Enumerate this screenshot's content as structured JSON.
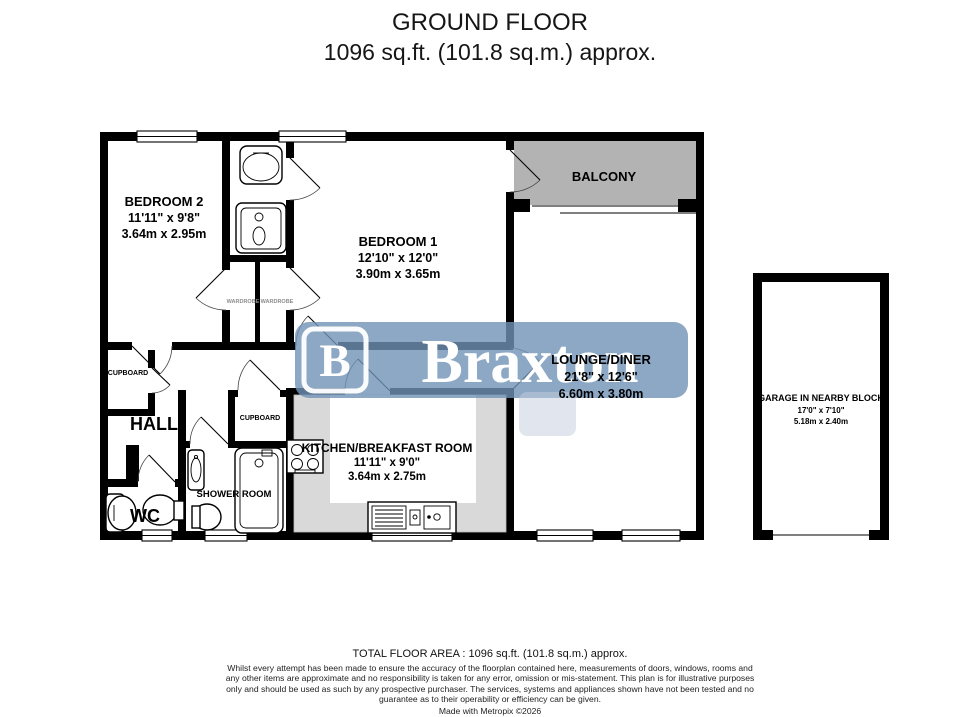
{
  "title": {
    "line1": "GROUND FLOOR",
    "line2": "1096 sq.ft. (101.8 sq.m.) approx."
  },
  "watermark": {
    "brand": "Braxton",
    "logo_letter": "B"
  },
  "rooms": {
    "bedroom2": {
      "name": "BEDROOM 2",
      "dims_ft": "11'11\" x 9'8\"",
      "dims_m": "3.64m x 2.95m"
    },
    "bedroom1": {
      "name": "BEDROOM 1",
      "dims_ft": "12'10\" x 12'0\"",
      "dims_m": "3.90m x 3.65m"
    },
    "balcony": {
      "name": "BALCONY"
    },
    "lounge": {
      "name": "LOUNGE/DINER",
      "dims_ft": "21'8\" x 12'6\"",
      "dims_m": "6.60m x 3.80m"
    },
    "kitchen": {
      "name": "KITCHEN/BREAKFAST ROOM",
      "dims_ft": "11'11\" x 9'0\"",
      "dims_m": "3.64m x 2.75m"
    },
    "hall": {
      "name": "HALL"
    },
    "wc": {
      "name": "WC"
    },
    "shower_room": {
      "name": "SHOWER ROOM"
    },
    "cupboard_hall": {
      "name": "CUPBOARD"
    },
    "cupboard_inner": {
      "name": "CUPBOARD"
    },
    "wardrobe_a": {
      "name": "WARDROBE"
    },
    "wardrobe_b": {
      "name": "WARDROBE"
    },
    "garage": {
      "name": "GARAGE IN NEARBY BLOCK",
      "dims_ft": "17'0\" x 7'10\"",
      "dims_m": "5.18m x 2.40m"
    }
  },
  "footer": {
    "total": "TOTAL FLOOR AREA : 1096 sq.ft. (101.8 sq.m.) approx.",
    "disclaimer": "Whilst every attempt has been made to ensure the accuracy of the floorplan contained here, measurements of doors, windows, rooms and any other items are approximate and no responsibility is taken for any error, omission or mis-statement. This plan is for illustrative purposes only and should be used as such by any prospective purchaser. The services, systems and appliances shown have not been tested and no guarantee as to their operability or efficiency can be given.",
    "credit": "Made with Metropix ©2026"
  },
  "colors": {
    "wall": "#000000",
    "balcony_fill": "#b3b3b3",
    "counter_fill": "#d9d9d9",
    "watermark_blue": "#7092b6",
    "watermark_text": "#ffffff"
  }
}
